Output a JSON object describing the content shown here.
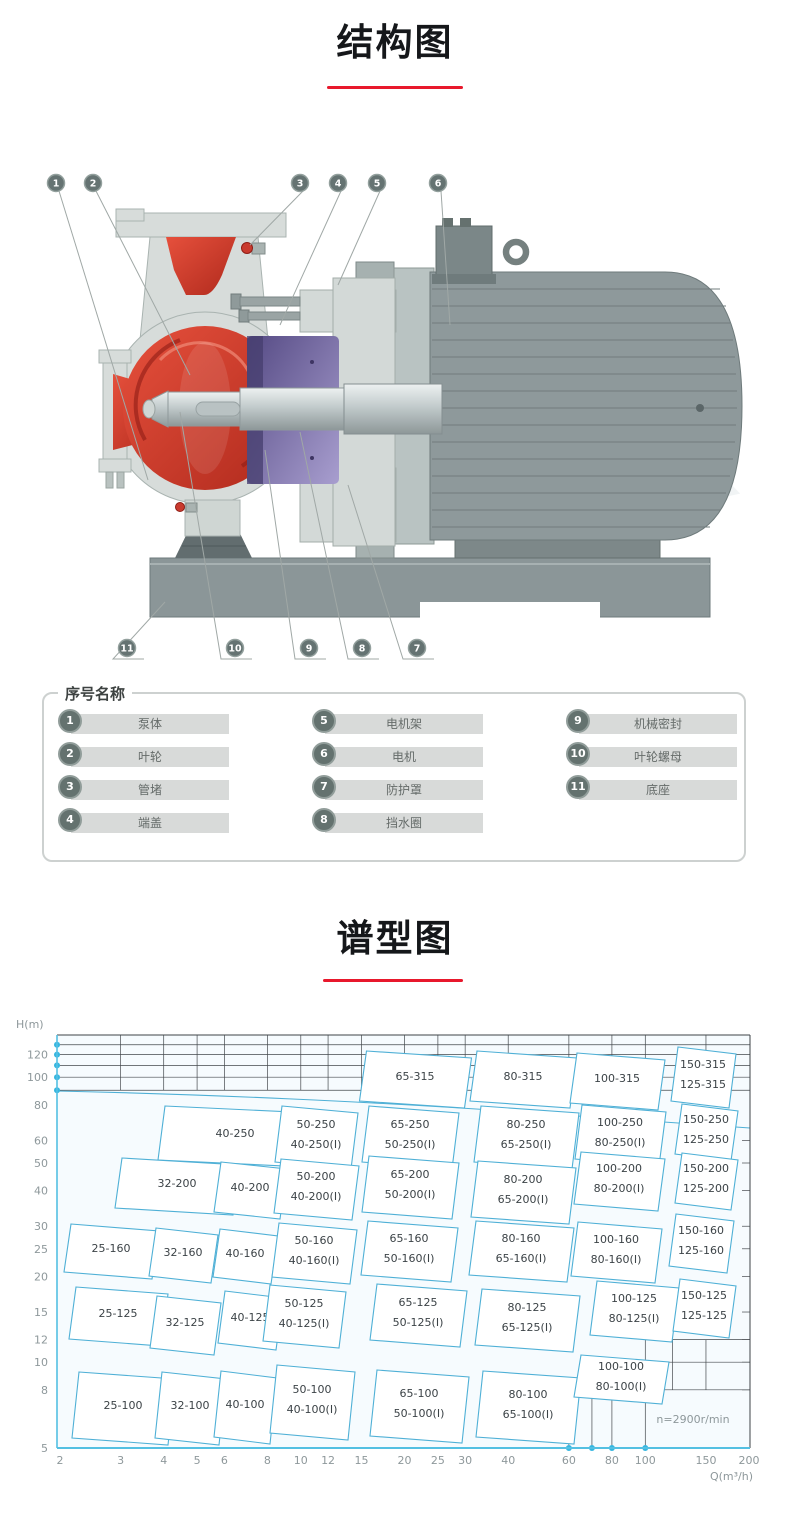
{
  "structure_section": {
    "title": "结构图",
    "underline_color": "#e8182c",
    "callouts_top": [
      "1",
      "2",
      "3",
      "4",
      "5",
      "6"
    ],
    "callouts_bottom": [
      "11",
      "10",
      "9",
      "8",
      "7"
    ]
  },
  "parts_panel": {
    "legend": "序号名称",
    "items": [
      {
        "num": "1",
        "label": "泵体"
      },
      {
        "num": "2",
        "label": "叶轮"
      },
      {
        "num": "3",
        "label": "管堵"
      },
      {
        "num": "4",
        "label": "端盖"
      },
      {
        "num": "5",
        "label": "电机架"
      },
      {
        "num": "6",
        "label": "电机"
      },
      {
        "num": "7",
        "label": "防护罩"
      },
      {
        "num": "8",
        "label": "挡水圈"
      },
      {
        "num": "9",
        "label": "机械密封"
      },
      {
        "num": "10",
        "label": "叶轮螺母"
      },
      {
        "num": "11",
        "label": "底座"
      }
    ]
  },
  "chart_section": {
    "title": "谱型图",
    "underline_color": "#e8182c"
  },
  "chart_data": {
    "type": "table",
    "title": "谱型图",
    "xlabel": "Q(m³/h)",
    "ylabel": "H(m)",
    "x_scale": "log",
    "y_scale": "log",
    "x_ticks": [
      2,
      3,
      4,
      5,
      6,
      8,
      10,
      12,
      15,
      20,
      25,
      30,
      40,
      60,
      80,
      100,
      150,
      200
    ],
    "y_ticks": [
      5,
      8,
      10,
      12,
      15,
      20,
      25,
      30,
      40,
      50,
      60,
      80,
      100,
      120
    ],
    "top_gridlines_H": [
      90,
      100,
      110,
      120,
      130
    ],
    "right_ticks_H": [
      8,
      10,
      12,
      15,
      20,
      25,
      30,
      40,
      50,
      60
    ],
    "axis_dots_H": [
      90,
      100,
      110,
      120,
      130
    ],
    "axis_dots_Q": [
      60,
      70,
      80,
      100
    ],
    "note": "n=2900r/min",
    "cell_color": "#4fb0d6",
    "cells": [
      {
        "labels": [
          "65-315"
        ],
        "x": 412,
        "y": 76,
        "w": 105,
        "h": 50
      },
      {
        "labels": [
          "80-315"
        ],
        "x": 520,
        "y": 76,
        "w": 100,
        "h": 50
      },
      {
        "labels": [
          "100-315"
        ],
        "x": 614,
        "y": 78,
        "w": 88,
        "h": 50
      },
      {
        "labels": [
          "150-315",
          "125-315"
        ],
        "x": 700,
        "y": 74,
        "w": 58,
        "h": 54
      },
      {
        "labels": [
          "40-250"
        ],
        "x": 232,
        "y": 133,
        "w": 148,
        "h": 54
      },
      {
        "labels": [
          "50-250",
          "40-250(I)"
        ],
        "x": 313,
        "y": 134,
        "w": 76,
        "h": 56
      },
      {
        "labels": [
          "65-250",
          "50-250(I)"
        ],
        "x": 407,
        "y": 134,
        "w": 90,
        "h": 56
      },
      {
        "labels": [
          "80-250",
          "65-250(I)"
        ],
        "x": 523,
        "y": 134,
        "w": 98,
        "h": 56
      },
      {
        "labels": [
          "100-250",
          "80-250(I)"
        ],
        "x": 617,
        "y": 132,
        "w": 84,
        "h": 54
      },
      {
        "labels": [
          "150-250",
          "125-250"
        ],
        "x": 703,
        "y": 129,
        "w": 56,
        "h": 50
      },
      {
        "labels": [
          "32-200"
        ],
        "x": 174,
        "y": 183,
        "w": 118,
        "h": 50
      },
      {
        "labels": [
          "40-200"
        ],
        "x": 247,
        "y": 187,
        "w": 66,
        "h": 50
      },
      {
        "labels": [
          "50-200",
          "40-200(I)"
        ],
        "x": 313,
        "y": 186,
        "w": 78,
        "h": 54
      },
      {
        "labels": [
          "65-200",
          "50-200(I)"
        ],
        "x": 407,
        "y": 184,
        "w": 90,
        "h": 56
      },
      {
        "labels": [
          "80-200",
          "65-200(I)"
        ],
        "x": 520,
        "y": 189,
        "w": 98,
        "h": 56
      },
      {
        "labels": [
          "100-200",
          "80-200(I)"
        ],
        "x": 616,
        "y": 178,
        "w": 84,
        "h": 52
      },
      {
        "labels": [
          "150-200",
          "125-200"
        ],
        "x": 703,
        "y": 178,
        "w": 56,
        "h": 50
      },
      {
        "labels": [
          "25-160"
        ],
        "x": 108,
        "y": 248,
        "w": 88,
        "h": 48
      },
      {
        "labels": [
          "32-160"
        ],
        "x": 180,
        "y": 252,
        "w": 62,
        "h": 48
      },
      {
        "labels": [
          "40-160"
        ],
        "x": 242,
        "y": 253,
        "w": 58,
        "h": 48
      },
      {
        "labels": [
          "50-160",
          "40-160(I)"
        ],
        "x": 311,
        "y": 250,
        "w": 78,
        "h": 54
      },
      {
        "labels": [
          "65-160",
          "50-160(I)"
        ],
        "x": 406,
        "y": 248,
        "w": 90,
        "h": 54
      },
      {
        "labels": [
          "80-160",
          "65-160(I)"
        ],
        "x": 518,
        "y": 248,
        "w": 98,
        "h": 54
      },
      {
        "labels": [
          "100-160",
          "80-160(I)"
        ],
        "x": 613,
        "y": 249,
        "w": 84,
        "h": 54
      },
      {
        "labels": [
          "150-160",
          "125-160"
        ],
        "x": 698,
        "y": 240,
        "w": 58,
        "h": 52
      },
      {
        "labels": [
          "25-125"
        ],
        "x": 115,
        "y": 313,
        "w": 92,
        "h": 52
      },
      {
        "labels": [
          "32-125"
        ],
        "x": 182,
        "y": 322,
        "w": 64,
        "h": 52
      },
      {
        "labels": [
          "40-125"
        ],
        "x": 247,
        "y": 317,
        "w": 58,
        "h": 52
      },
      {
        "labels": [
          "50-125",
          "40-125(I)"
        ],
        "x": 301,
        "y": 313,
        "w": 76,
        "h": 56
      },
      {
        "labels": [
          "65-125",
          "50-125(I)"
        ],
        "x": 415,
        "y": 312,
        "w": 90,
        "h": 56
      },
      {
        "labels": [
          "80-125",
          "65-125(I)"
        ],
        "x": 524,
        "y": 317,
        "w": 98,
        "h": 56
      },
      {
        "labels": [
          "100-125",
          "80-125(I)"
        ],
        "x": 631,
        "y": 308,
        "w": 82,
        "h": 54
      },
      {
        "labels": [
          "150-125",
          "125-125"
        ],
        "x": 701,
        "y": 305,
        "w": 56,
        "h": 52
      },
      {
        "labels": [
          "25-100"
        ],
        "x": 120,
        "y": 405,
        "w": 96,
        "h": 66
      },
      {
        "labels": [
          "32-100"
        ],
        "x": 187,
        "y": 405,
        "w": 64,
        "h": 66
      },
      {
        "labels": [
          "40-100"
        ],
        "x": 242,
        "y": 404,
        "w": 56,
        "h": 66
      },
      {
        "labels": [
          "50-100",
          "40-100(I)"
        ],
        "x": 309,
        "y": 399,
        "w": 78,
        "h": 68
      },
      {
        "labels": [
          "65-100",
          "50-100(I)"
        ],
        "x": 416,
        "y": 403,
        "w": 92,
        "h": 66
      },
      {
        "labels": [
          "80-100",
          "65-100(I)"
        ],
        "x": 525,
        "y": 404,
        "w": 98,
        "h": 66
      },
      {
        "labels": [
          "100-100",
          "80-100(I)"
        ],
        "x": 618,
        "y": 376,
        "w": 88,
        "h": 42
      }
    ]
  }
}
